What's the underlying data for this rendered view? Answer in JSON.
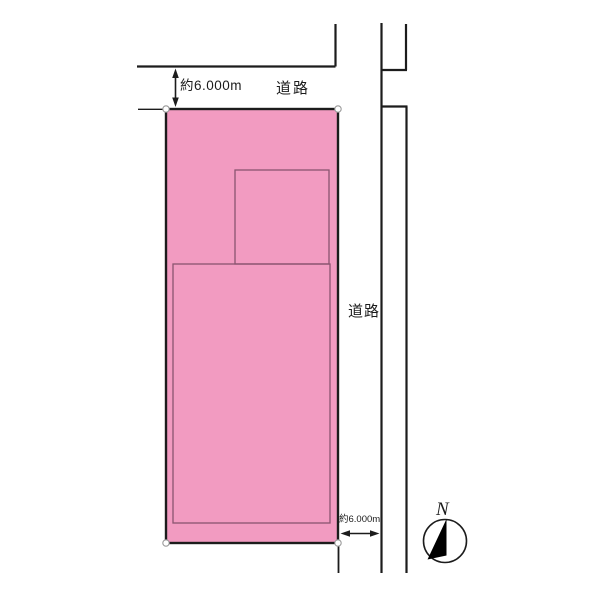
{
  "plot_map": {
    "labels": {
      "north_road": "道路",
      "north_road_width": "約6.000m",
      "east_road": "道路",
      "east_road_width": "約6.000m"
    },
    "compass": {
      "north": "N",
      "needle_color": "#000000",
      "ring_color": "#1c1c1c"
    },
    "colors": {
      "parcel_fill": "#F29BC1",
      "parcel_border": "#1c1c1c",
      "building_outline": "#8a5570",
      "road_line": "#1c1c1c",
      "dimension_line": "#1c1c1c",
      "marker_fill": "#ffffff",
      "marker_stroke": "#9a9a9a",
      "text": "#1c1c1c"
    }
  }
}
